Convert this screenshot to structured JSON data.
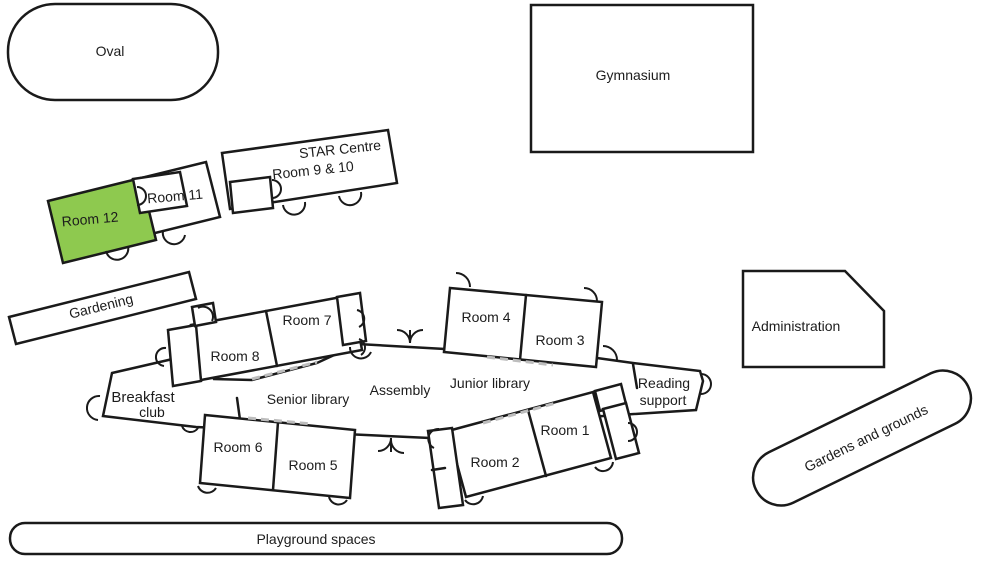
{
  "areas": {
    "oval": {
      "label": "Oval"
    },
    "gymnasium": {
      "label": "Gymnasium"
    },
    "star_centre": {
      "label_line1": "STAR Centre",
      "label_line2": "Room 9 & 10"
    },
    "room_11": {
      "label": "Room 11"
    },
    "room_12": {
      "label": "Room 12",
      "highlighted": true
    },
    "gardening": {
      "label": "Gardening"
    },
    "administration": {
      "label": "Administration"
    },
    "breakfast_club": {
      "label_line1": "Breakfast",
      "label_line2": "club"
    },
    "senior_library": {
      "label": "Senior library"
    },
    "assembly": {
      "label": "Assembly"
    },
    "junior_library": {
      "label": "Junior library"
    },
    "reading_support": {
      "label_line1": "Reading",
      "label_line2": "support"
    },
    "room_8": {
      "label": "Room 8"
    },
    "room_7": {
      "label": "Room 7"
    },
    "room_4": {
      "label": "Room 4"
    },
    "room_3": {
      "label": "Room 3"
    },
    "room_6": {
      "label": "Room 6"
    },
    "room_5": {
      "label": "Room 5"
    },
    "room_2": {
      "label": "Room 2"
    },
    "room_1": {
      "label": "Room 1"
    },
    "gardens_grounds": {
      "label": "Gardens and grounds"
    },
    "playground": {
      "label": "Playground spaces"
    }
  },
  "colors": {
    "highlight_green": "#8EC94F",
    "wall": "#1A1A1A",
    "walkway_dash": "#BDBDBD",
    "background": "#FFFFFF"
  }
}
